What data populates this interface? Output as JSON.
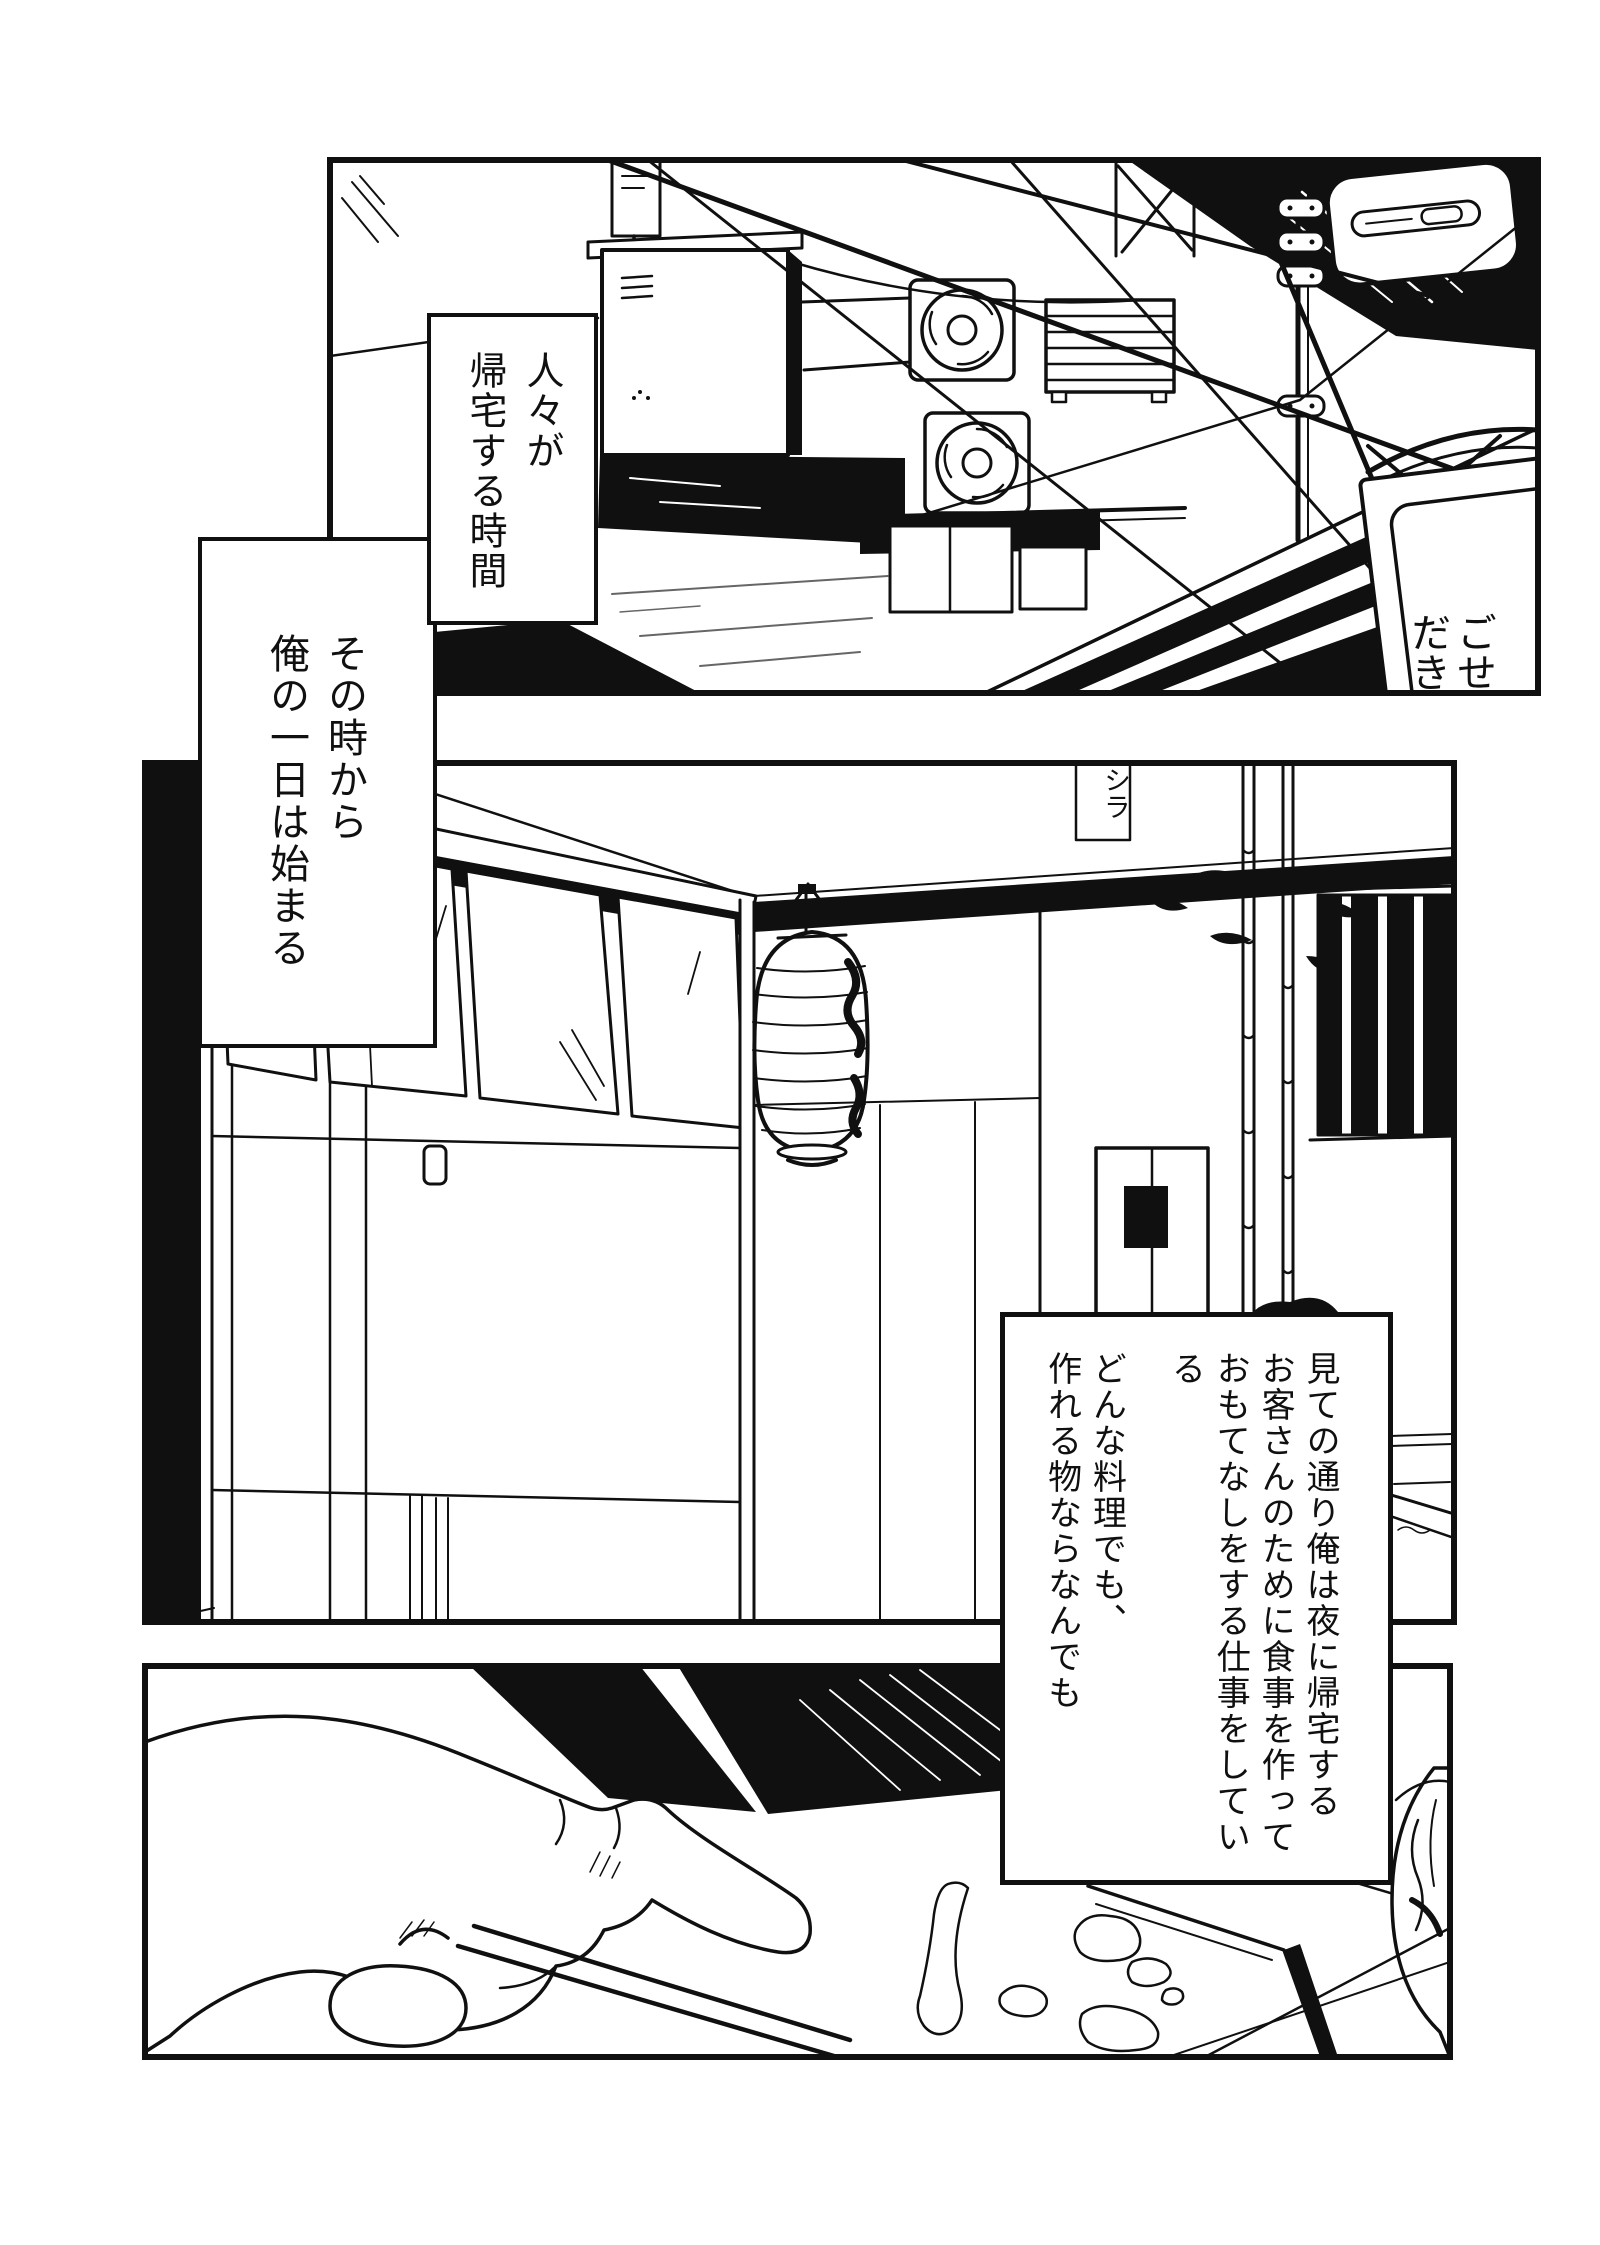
{
  "page": {
    "width": 1600,
    "height": 2245,
    "background": "#ffffff",
    "ink": "#101010"
  },
  "panels": [
    {
      "name": "panel-alley-evening"
    },
    {
      "name": "panel-izakaya-storefront"
    },
    {
      "name": "panel-hand-with-chopsticks"
    }
  ],
  "narration": [
    {
      "columns": [
        "人々が",
        "帰宅する時間"
      ]
    },
    {
      "columns": [
        "その時から",
        "俺の一日は始まる"
      ]
    },
    {
      "columns": [
        "見ての通り俺は夜に帰宅する",
        "お客さんのために食事を作って",
        "おもてなしをする仕事をしている",
        "どんな料理でも、",
        "作れる物ならなんでも"
      ]
    }
  ],
  "signs": {
    "andon_columns": [
      "ごせ",
      "だき"
    ],
    "wall_tag": "シラ"
  }
}
